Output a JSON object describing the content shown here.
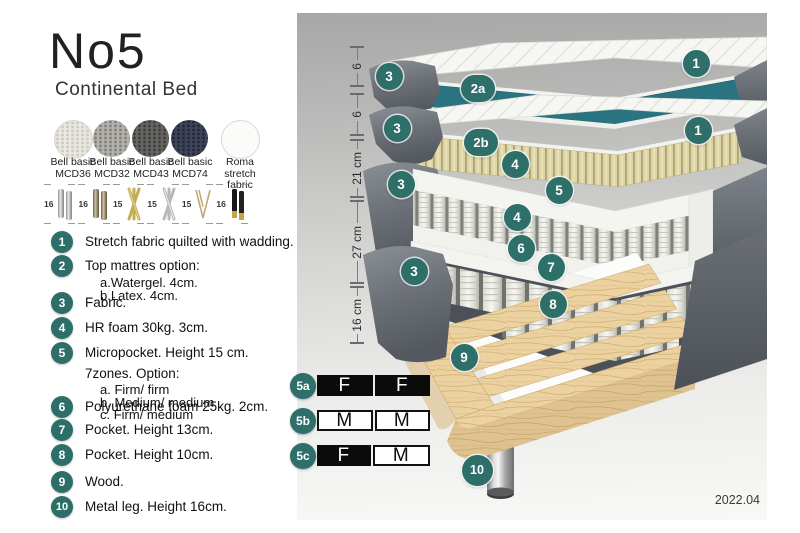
{
  "header": {
    "title": "No5",
    "subtitle": "Continental Bed"
  },
  "fabrics": [
    {
      "name": "Bell basic",
      "code": "MCD36"
    },
    {
      "name": "Bell basic",
      "code": "MCD32"
    },
    {
      "name": "Bell basic",
      "code": "MCD43"
    },
    {
      "name": "Bell basic",
      "code": "MCD74"
    },
    {
      "name": "Roma",
      "code": "stretch fabric"
    }
  ],
  "leg_options": [
    {
      "height": "16",
      "style": "cylinder-silver"
    },
    {
      "height": "16",
      "style": "cylinder-bronze"
    },
    {
      "height": "15",
      "style": "cross-gold"
    },
    {
      "height": "15",
      "style": "cross-silver"
    },
    {
      "height": "15",
      "style": "hairpin"
    },
    {
      "height": "16",
      "style": "cylinder-black-gold"
    }
  ],
  "legend": [
    {
      "num": "1",
      "text": "Stretch fabric quilted with wadding."
    },
    {
      "num": "2",
      "text": "Top mattres option:",
      "subs": [
        "a.Watergel. 4cm.",
        "b.Latex. 4cm."
      ]
    },
    {
      "num": "3",
      "text": "Fabric."
    },
    {
      "num": "4",
      "text": "HR foam 30kg. 3cm."
    },
    {
      "num": "5",
      "text": "Micropocket. Height 15 cm. 7zones. Option:",
      "subs": [
        "a. Firm/ firm",
        "b. Medium/ medium",
        "c. Firm/ medium"
      ]
    },
    {
      "num": "6",
      "text": "Polyurethane foam 25kg. 2cm."
    },
    {
      "num": "7",
      "text": "Pocket. Height 13cm."
    },
    {
      "num": "8",
      "text": "Pocket. Height 10cm."
    },
    {
      "num": "9",
      "text": "Wood."
    },
    {
      "num": "10",
      "text": "Metal leg. Height 16cm."
    }
  ],
  "ruler": {
    "segments": [
      {
        "label": "6"
      },
      {
        "label": "6"
      },
      {
        "label": "21 cm"
      },
      {
        "label": "27 cm"
      },
      {
        "label": "16 cm"
      }
    ]
  },
  "callouts": [
    {
      "label": "1"
    },
    {
      "label": "2a"
    },
    {
      "label": "3"
    },
    {
      "label": "1"
    },
    {
      "label": "2b"
    },
    {
      "label": "3"
    },
    {
      "label": "4"
    },
    {
      "label": "3"
    },
    {
      "label": "5"
    },
    {
      "label": "4"
    },
    {
      "label": "6"
    },
    {
      "label": "7"
    },
    {
      "label": "3"
    },
    {
      "label": "8"
    },
    {
      "label": "9"
    },
    {
      "label": "10"
    }
  ],
  "firmness": {
    "rows": [
      {
        "id": "5a",
        "cells": [
          {
            "letter": "F",
            "filled": true
          },
          {
            "letter": "F",
            "filled": true
          }
        ]
      },
      {
        "id": "5b",
        "cells": [
          {
            "letter": "M",
            "filled": false
          },
          {
            "letter": "M",
            "filled": false
          }
        ]
      },
      {
        "id": "5c",
        "cells": [
          {
            "letter": "F",
            "filled": true
          },
          {
            "letter": "M",
            "filled": false
          }
        ]
      }
    ]
  },
  "footer": {
    "version": "2022.04"
  },
  "colors": {
    "accent_teal": "#2e6f69",
    "layer_teal": "#2a7381",
    "wood": "#ecd2a0",
    "gray_fabric": "#70747b"
  }
}
